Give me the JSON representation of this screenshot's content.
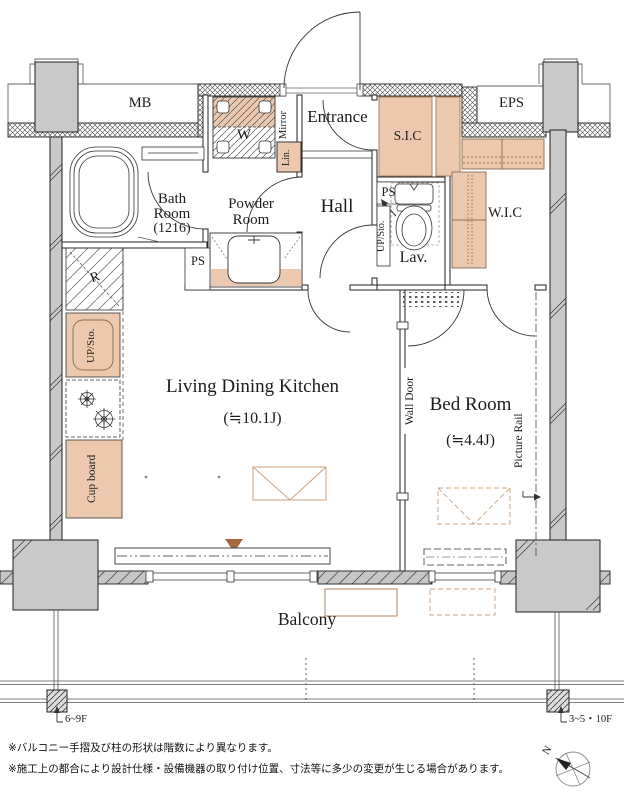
{
  "rooms": {
    "mb": "MB",
    "eps": "EPS",
    "entrance": "Entrance",
    "sic": "S.I.C",
    "wic": "W.I.C",
    "hall": "Hall",
    "lav": "Lav.",
    "bath_line1": "Bath",
    "bath_line2": "Room",
    "bath_line3": "(1216)",
    "powder_line1": "Powder",
    "powder_line2": "Room",
    "ldk_name": "Living Dining Kitchen",
    "ldk_size": "(≒10.1J)",
    "bed_name": "Bed Room",
    "bed_size": "(≒4.4J)",
    "balcony": "Balcony"
  },
  "fixtures": {
    "washer": "W",
    "mirror": "Mirror",
    "linen": "Lin.",
    "ps_powder": "PS",
    "ps_lav": "PS",
    "up_sto_lav": "UP/Sto.",
    "up_sto_kitchen": "UP/Sto.",
    "refrigerator": "R",
    "cupboard": "Cup board",
    "wall_door": "Wall Door",
    "picture_rail": "Picture Rail"
  },
  "annotations": {
    "floor_left": "6~9F",
    "floor_right": "3~5・10F",
    "note1": "※バルコニー手摺及び柱の形状は階数により異なります。",
    "note2": "※施工上の都合により設計仕様・設備機器の取り付け位置、寸法等に多少の変更が生じる場合があります。",
    "compass_north": "N"
  },
  "colors": {
    "accent_tan": "#ecc9ae",
    "tan_outline": "#a3764f",
    "triangle_brown": "#a9663a",
    "column_gray": "#c9c9c9"
  }
}
